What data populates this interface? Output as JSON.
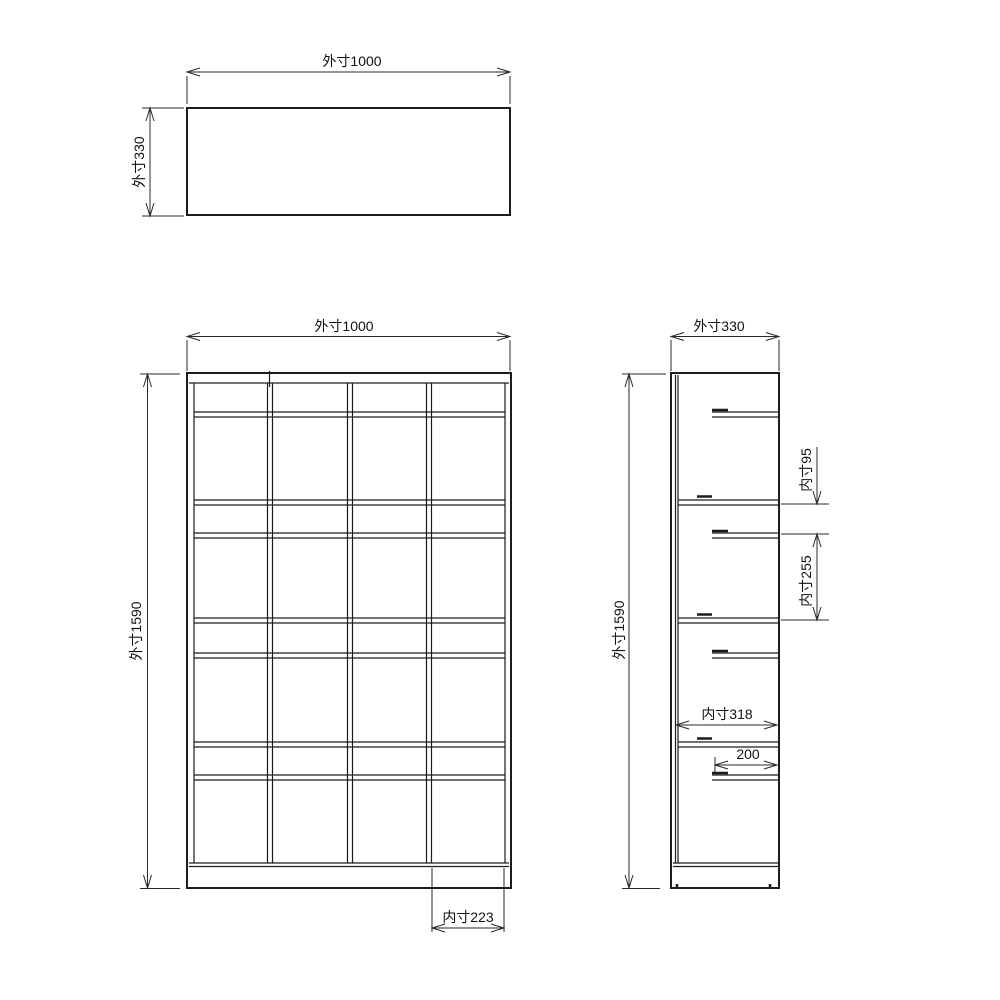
{
  "title": "shelf-unit-technical-drawing",
  "colors": {
    "background": "#ffffff",
    "line": "#1c1c1c",
    "text": "#111111"
  },
  "labels": {
    "top_view_width": "外寸1000",
    "top_view_depth": "外寸330",
    "front_view_width": "外寸1000",
    "front_view_height": "外寸1590",
    "front_view_inner_width": "内寸223",
    "side_view_depth": "外寸330",
    "side_view_height": "外寸1590",
    "side_view_inner_height_small": "内寸95",
    "side_view_inner_height_large": "内寸255",
    "side_view_inner_depth": "内寸318",
    "side_view_shelf_depth": "200"
  },
  "dimensions_mm": {
    "outer_width": 1000,
    "outer_depth": 330,
    "outer_height": 1590,
    "inner_column_width": 223,
    "inner_row_height_small": 95,
    "inner_row_height_large": 255,
    "inner_depth": 318,
    "upper_shelf_depth": 200
  },
  "structure": {
    "views": [
      "top",
      "front",
      "side"
    ],
    "front_columns": 4,
    "front_rows": 8,
    "full_depth_shelves": 3,
    "partial_depth_shelves": 4
  }
}
